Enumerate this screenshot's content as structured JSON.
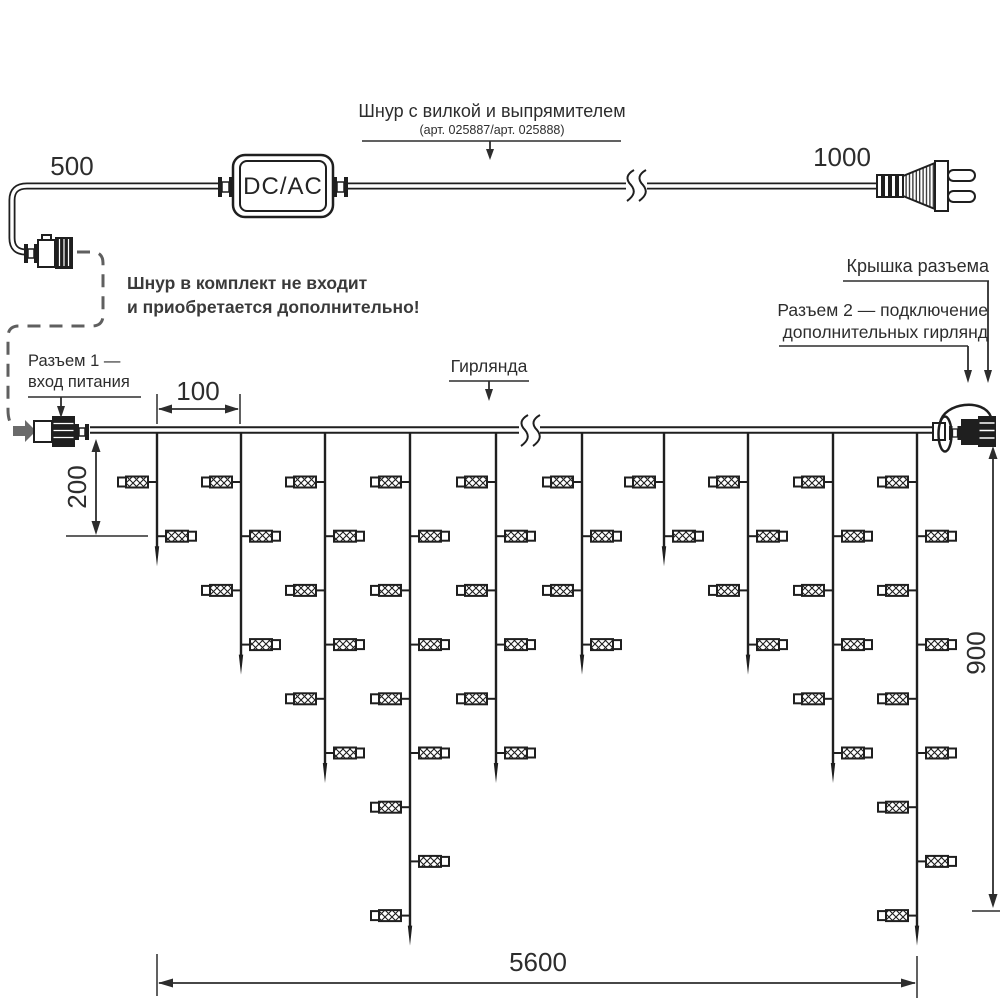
{
  "colors": {
    "ink": "#1f1f1f",
    "text": "#2d2d2d",
    "gray_dash": "#5f5f5f",
    "gray_arrow": "#6a6a6a",
    "background": "#ffffff"
  },
  "top": {
    "dim_left": "500",
    "dim_right": "1000",
    "adapter_label": "DC/AC",
    "cord_title": "Шнур с вилкой и выпрямителем",
    "cord_subtitle": "(арт. 025887/арт. 025888)",
    "note_line1": "Шнур в комплект не входит",
    "note_line2": "и приобретается дополнительно!"
  },
  "labels": {
    "connector1_line1": "Разъем 1 —",
    "connector1_line2": "вход питания",
    "garland": "Гирлянда",
    "cap": "Крышка разъема",
    "connector2_line1": "Разъем 2 — подключение",
    "connector2_line2": "дополнительных гирлянд"
  },
  "dims": {
    "drop_spacing": "100",
    "first_drop_height": "200",
    "curtain_height": "900",
    "total_length": "5600"
  },
  "garland": {
    "wire": {
      "x1": 90,
      "x2": 933,
      "y": 430
    },
    "row_start_y": 482,
    "row_gap": 54.2,
    "tip_extend": 30,
    "lamp": {
      "body_w": 22,
      "body_h": 11,
      "cap_w": 8,
      "cap_h": 9,
      "stub": 9
    },
    "drops": [
      {
        "x": 157,
        "lamps": 2
      },
      {
        "x": 241,
        "lamps": 4
      },
      {
        "x": 325,
        "lamps": 6
      },
      {
        "x": 410,
        "lamps": 9
      },
      {
        "x": 496,
        "lamps": 6
      },
      {
        "x": 582,
        "lamps": 4
      },
      {
        "x": 664,
        "lamps": 2
      },
      {
        "x": 748,
        "lamps": 4
      },
      {
        "x": 833,
        "lamps": 6
      },
      {
        "x": 917,
        "lamps": 9
      }
    ]
  }
}
